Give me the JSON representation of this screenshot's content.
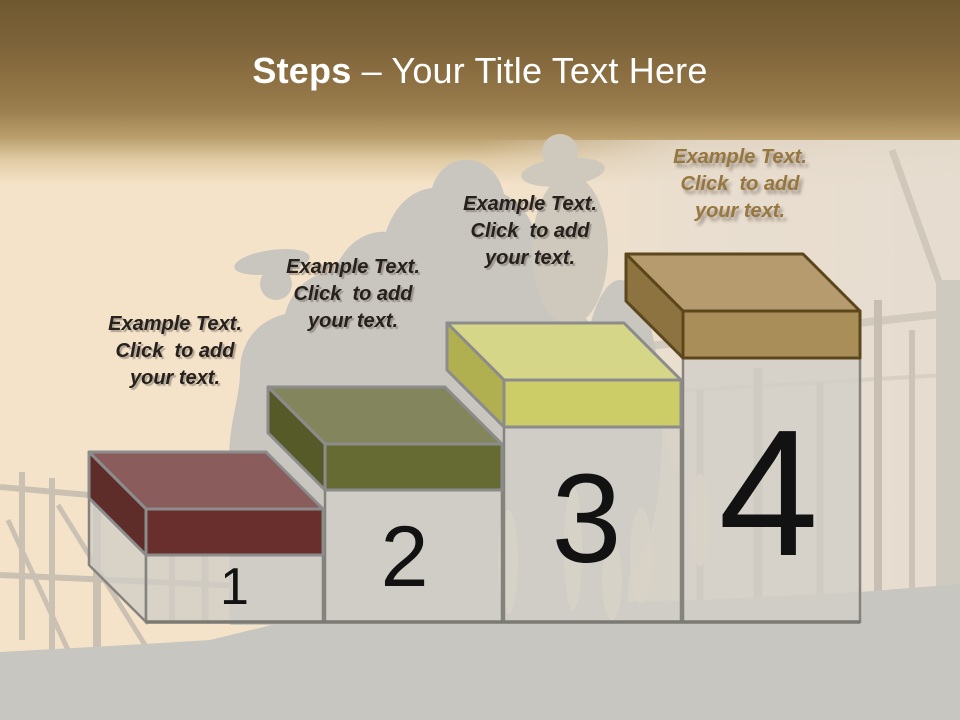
{
  "title": {
    "bold": "Steps",
    "rest": " – Your Title Text Here"
  },
  "steps": [
    {
      "number": "1",
      "label": "Example Text.\nClick  to add\nyour text.",
      "colors": {
        "top": "#8a5c5c",
        "left": "#5e2c29",
        "front": "#682f2c",
        "outline": "#8c8c8c"
      },
      "label_color": "#26211d"
    },
    {
      "number": "2",
      "label": "Example Text.\nClick  to add\nyour text.",
      "colors": {
        "top": "#83855c",
        "left": "#555a28",
        "front": "#666b33",
        "outline": "#8c8c8c"
      },
      "label_color": "#26211d"
    },
    {
      "number": "3",
      "label": "Example Text.\nClick  to add\nyour text.",
      "colors": {
        "top": "#d6d688",
        "left": "#b0b050",
        "front": "#cccd67",
        "outline": "#8c8c8c"
      },
      "label_color": "#26211d"
    },
    {
      "number": "4",
      "label": "Example Text.\nClick  to add\nyour text.",
      "colors": {
        "top": "#b59b6d",
        "left": "#8d7340",
        "front": "#aa8e59",
        "outline": "#5c471d"
      },
      "label_color": "#97773f"
    }
  ],
  "columns": {
    "fill": "rgba(209,206,199,0.78)",
    "outline": "#85837d",
    "baseline_color": "#7b7974",
    "number_color": "#121212"
  },
  "background": {
    "header_top": "#6f5830",
    "header_mid": "#9c7f4e",
    "body_left": "#f5e3c9",
    "body_right": "#e7ded0",
    "silhouette": "#c9c6c0",
    "ground": "#c8c6c0"
  }
}
